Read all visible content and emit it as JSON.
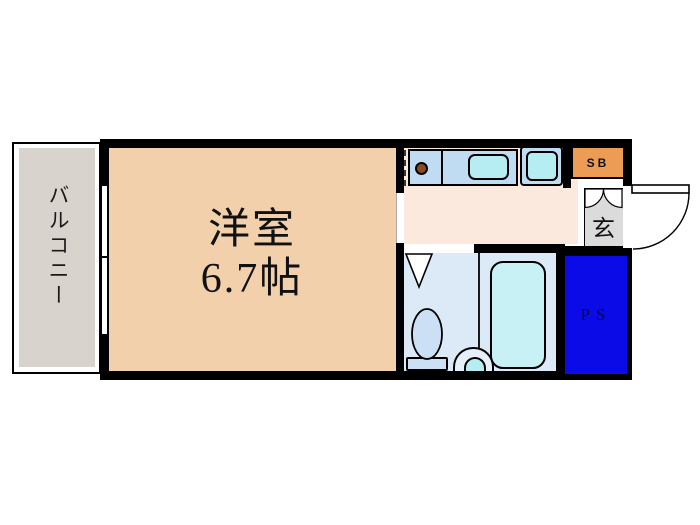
{
  "title": "apartment-floor-plan",
  "rooms": {
    "balcony": {
      "label": "バルコニー"
    },
    "main_room": {
      "label": "洋室",
      "size": "6.7帖"
    },
    "entrance": {
      "label": "玄"
    },
    "shoe_box": {
      "label": "SB"
    },
    "pipe_space": {
      "label": "PS"
    }
  },
  "fixtures": [
    "kitchen-counter",
    "gas-burner",
    "kitchen-sink",
    "washing-machine-space",
    "bathtub",
    "toilet",
    "washbasin",
    "entrance-door-swing",
    "balcony-window"
  ],
  "colors": {
    "walls": "#000000",
    "main_room": "#F2D0AC",
    "kitchen_floor": "#FAE9DC",
    "balcony": "#D8D3CD",
    "counter_blue": "#BFDCF2",
    "fixture_cyan": "#B5EDF3",
    "bath_floor": "#DCEAF8",
    "toilet_blue": "#CBE0F4",
    "bathtub_cyan": "#C7F1F5",
    "shoe_box_orange": "#EC9C54",
    "pipe_space_blue": "#0B0BE8",
    "entrance_gray": "#DBDBDB"
  }
}
